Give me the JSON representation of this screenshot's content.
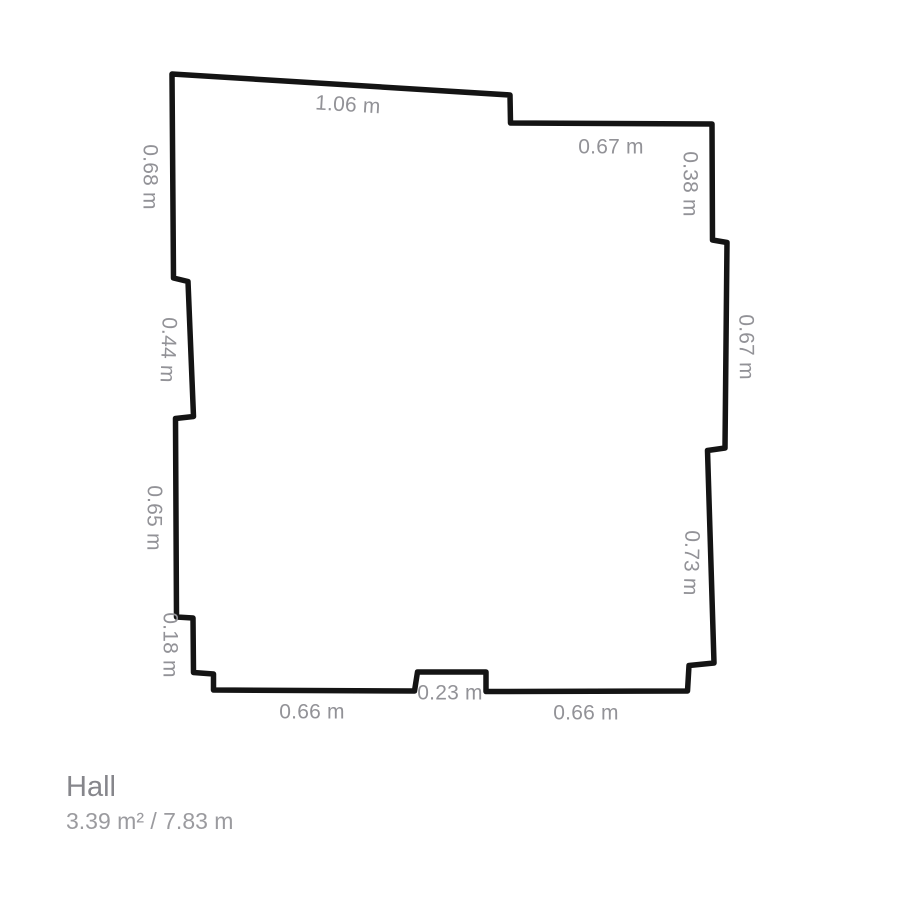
{
  "floorplan": {
    "background_color": "#ffffff",
    "fill_color": "#ffffff",
    "wall_color": "#141414",
    "wall_thickness": 5.5,
    "label_color": "#929297",
    "outline_points": [
      [
        172,
        74
      ],
      [
        510,
        95
      ],
      [
        510.5,
        123
      ],
      [
        712,
        124
      ],
      [
        712.5,
        240
      ],
      [
        727,
        242.5
      ],
      [
        725,
        448
      ],
      [
        707.5,
        450.5
      ],
      [
        714,
        663
      ],
      [
        689,
        665.5
      ],
      [
        687.5,
        691
      ],
      [
        486,
        691.5
      ],
      [
        486,
        672
      ],
      [
        417.5,
        672
      ],
      [
        414.5,
        691
      ],
      [
        213.5,
        690
      ],
      [
        213.5,
        674
      ],
      [
        193.5,
        672.5
      ],
      [
        193,
        618
      ],
      [
        176.5,
        617
      ],
      [
        175.5,
        418.5
      ],
      [
        193.5,
        416.5
      ],
      [
        188,
        281.5
      ],
      [
        173.5,
        278
      ]
    ],
    "dimension_labels": [
      {
        "text": "1.06 m",
        "x": 348,
        "y": 104,
        "rot": 3.5
      },
      {
        "text": "0.67 m",
        "x": 611,
        "y": 146,
        "rot": 0
      },
      {
        "text": "0.38 m",
        "x": 691,
        "y": 184,
        "rot": 90
      },
      {
        "text": "0.67 m",
        "x": 747,
        "y": 347,
        "rot": 89.5
      },
      {
        "text": "0.73 m",
        "x": 692,
        "y": 563,
        "rot": 91.5
      },
      {
        "text": "0.66 m",
        "x": 586,
        "y": 712,
        "rot": 0
      },
      {
        "text": "0.23 m",
        "x": 450,
        "y": 692,
        "rot": 0
      },
      {
        "text": "0.66 m",
        "x": 312,
        "y": 711,
        "rot": 0
      },
      {
        "text": "0.18 m",
        "x": 171,
        "y": 645,
        "rot": 90
      },
      {
        "text": "0.65 m",
        "x": 155,
        "y": 518,
        "rot": 90.5
      },
      {
        "text": "0.44 m",
        "x": 169,
        "y": 350,
        "rot": 92
      },
      {
        "text": "0.68 m",
        "x": 151,
        "y": 177,
        "rot": 90
      }
    ]
  },
  "footer": {
    "room_name": "Hall",
    "metrics": "3.39 m² / 7.83 m"
  }
}
